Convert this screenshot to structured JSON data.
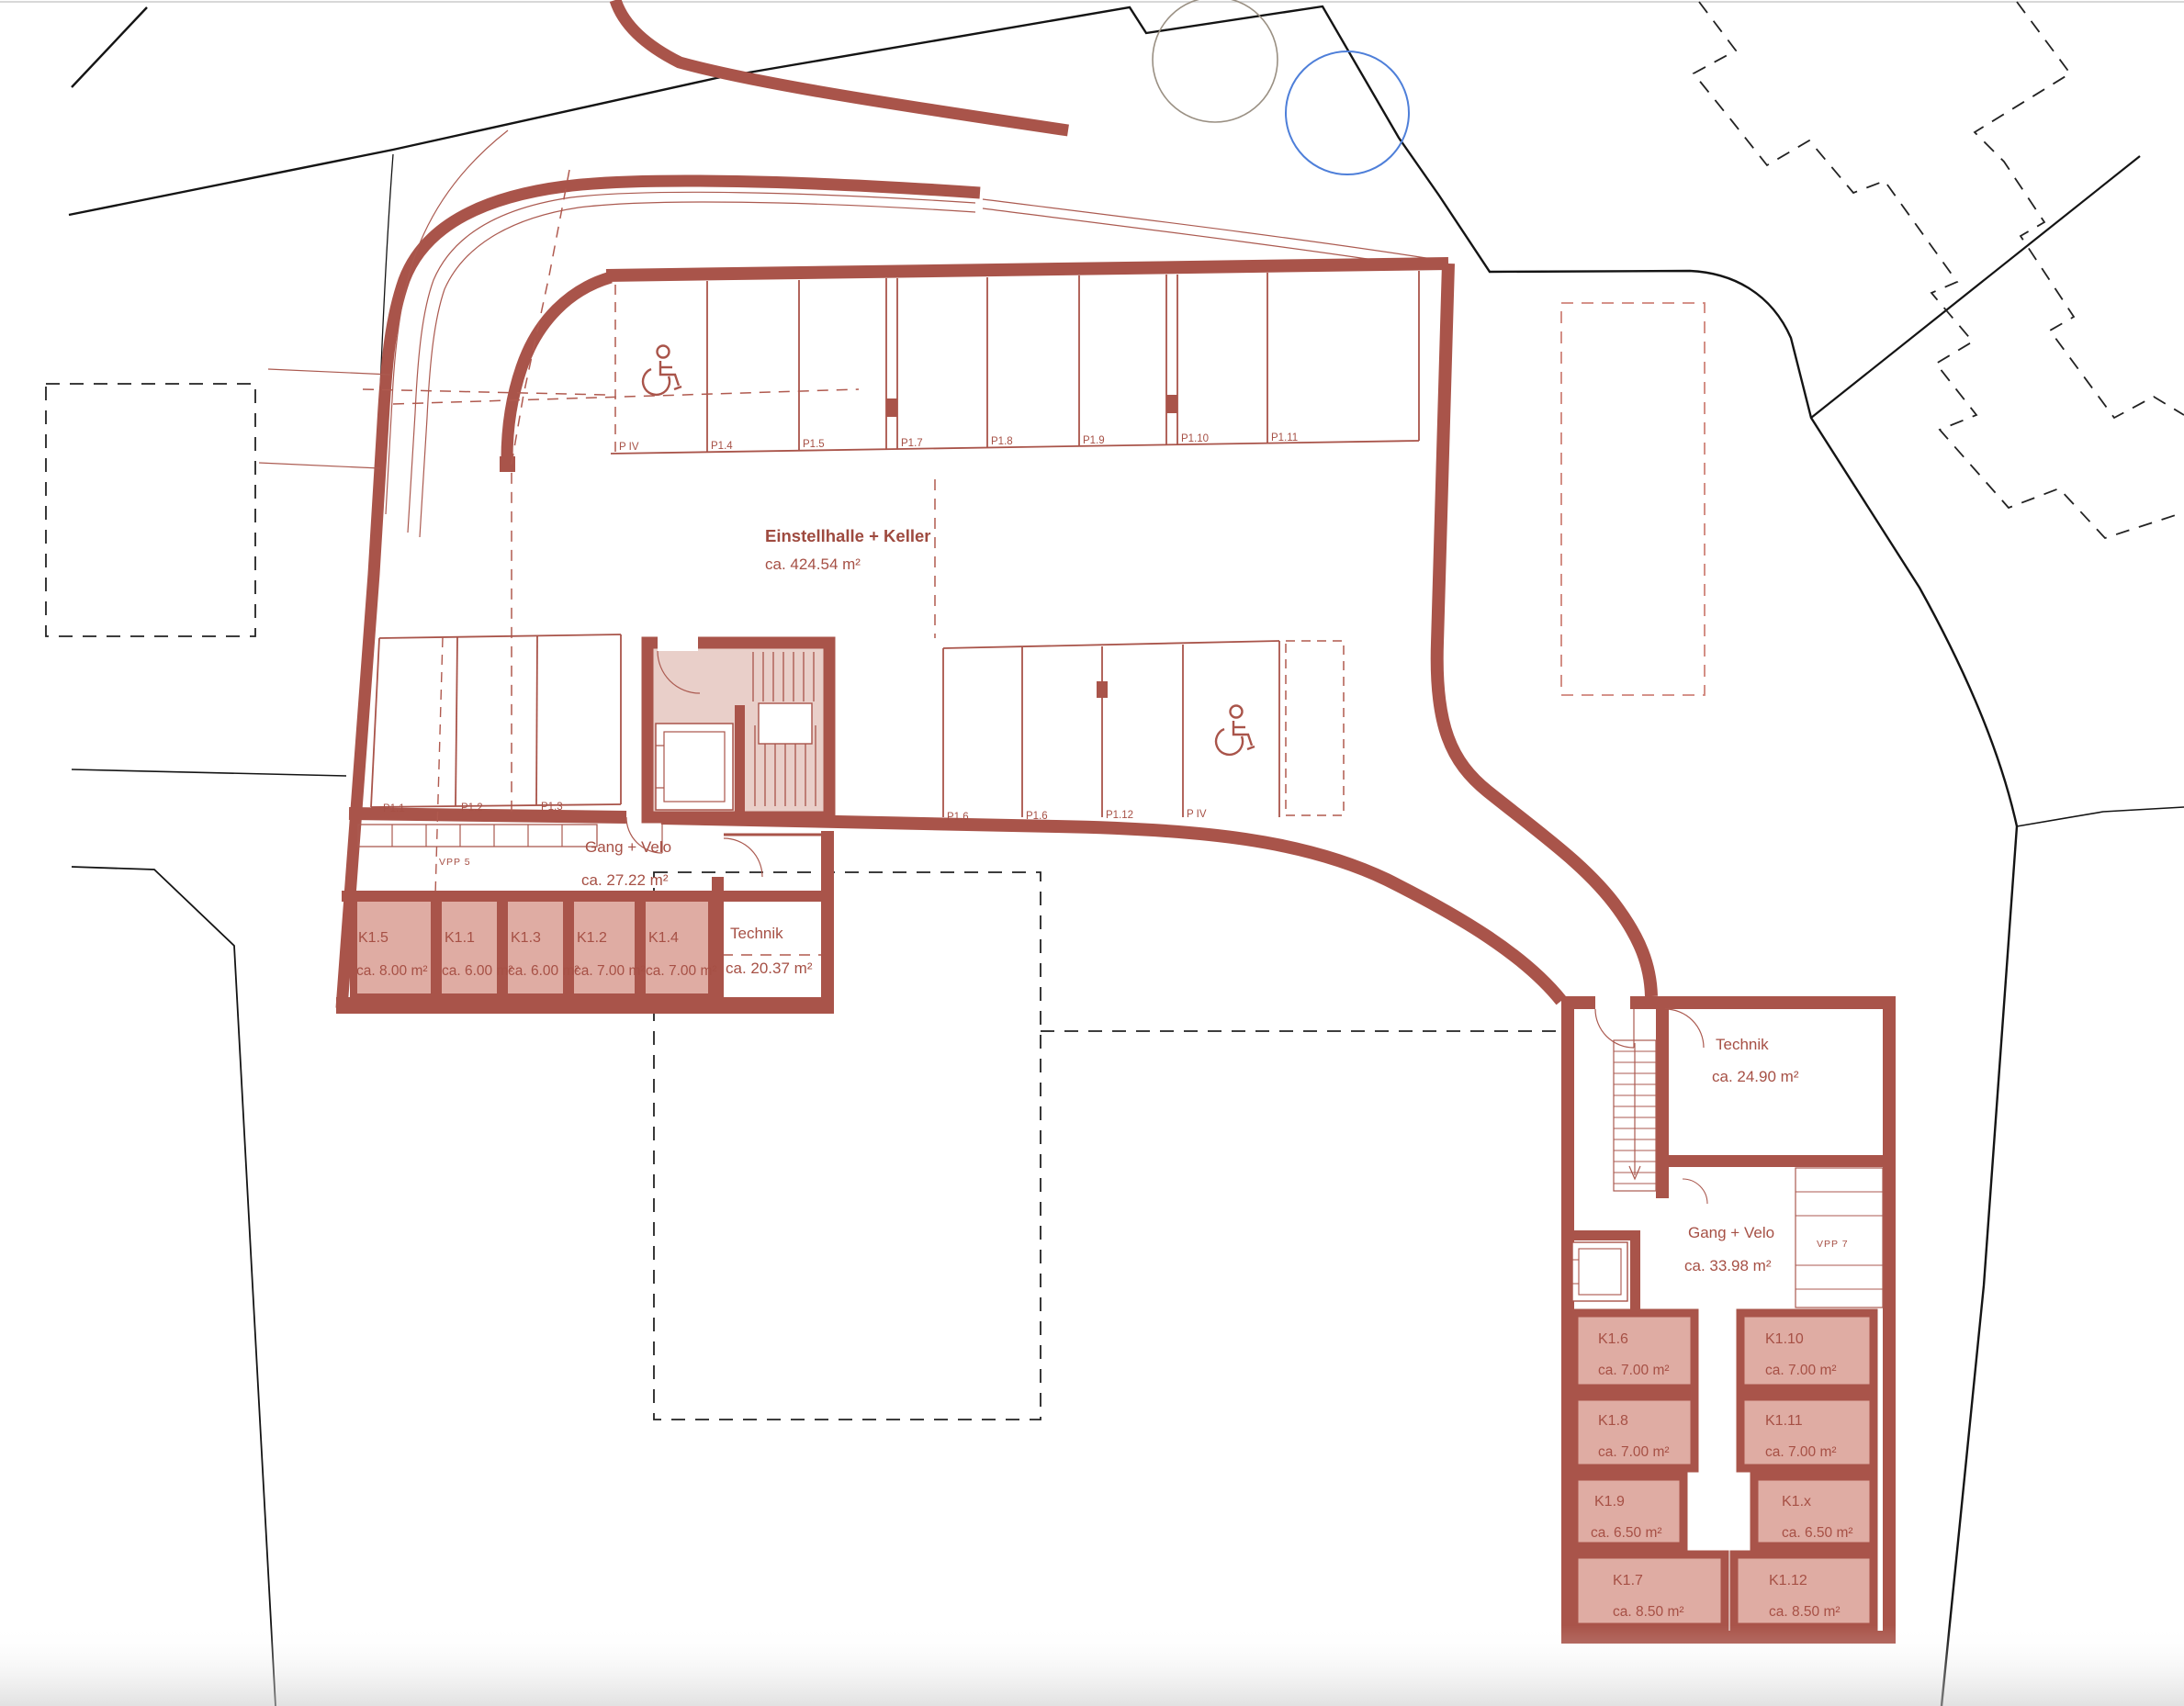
{
  "plan": {
    "hall": {
      "title": "Einstellhalle + Keller",
      "area": "ca. 424.54 m²"
    },
    "parking": {
      "top": [
        {
          "label": "P IV"
        },
        {
          "label": "P1.4"
        },
        {
          "label": "P1.5"
        },
        {
          "label": "P1.7"
        },
        {
          "label": "P1.8"
        },
        {
          "label": "P1.9"
        },
        {
          "label": "P1.10"
        },
        {
          "label": "P1.11"
        }
      ],
      "midLeft": [
        {
          "label": "P1.1"
        },
        {
          "label": "P1.2"
        },
        {
          "label": "P1.3"
        }
      ],
      "midRight": [
        {
          "label": "P1.6"
        },
        {
          "label": "P1.6"
        },
        {
          "label": "P1.12"
        },
        {
          "label": "P IV"
        }
      ]
    },
    "rooms": {
      "gangLeft": {
        "name": "Gang + Velo",
        "area": "ca. 27.22 m²"
      },
      "technikLeft": {
        "name": "Technik",
        "area": "ca. 20.37 m²"
      },
      "technikRight": {
        "name": "Technik",
        "area": "ca. 24.90 m²"
      },
      "gangRight": {
        "name": "Gang + Velo",
        "area": "ca. 33.98 m²"
      }
    },
    "bike": {
      "vpp5": "VPP 5",
      "vpp7": "VPP 7"
    },
    "storageLeft": [
      {
        "id": "K1.5",
        "area": "ca. 8.00 m²"
      },
      {
        "id": "K1.1",
        "area": "ca. 6.00 m²"
      },
      {
        "id": "K1.3",
        "area": "ca. 6.00 m²"
      },
      {
        "id": "K1.2",
        "area": "ca. 7.00 m²"
      },
      {
        "id": "K1.4",
        "area": "ca. 7.00 m²"
      }
    ],
    "storageRight": [
      {
        "id": "K1.6",
        "area": "ca. 7.00 m²"
      },
      {
        "id": "K1.10",
        "area": "ca. 7.00 m²"
      },
      {
        "id": "K1.8",
        "area": "ca. 7.00 m²"
      },
      {
        "id": "K1.11",
        "area": "ca. 7.00 m²"
      },
      {
        "id": "K1.9",
        "area": "ca. 6.50 m²"
      },
      {
        "id": "K1.x",
        "area": "ca. 6.50 m²"
      },
      {
        "id": "K1.7",
        "area": "ca. 8.50 m²"
      },
      {
        "id": "K1.12",
        "area": "ca. 8.50 m²"
      }
    ],
    "colors": {
      "wall": "#a9544a",
      "storageFill": "#dfaca3",
      "coreFill": "#e9cfc9",
      "labelRed": "#a65045",
      "pinkDash": "#cf8379",
      "siteBlack": "#141414",
      "neighborBlue": "#4e7fd9",
      "treeTan": "#9a9083"
    }
  }
}
